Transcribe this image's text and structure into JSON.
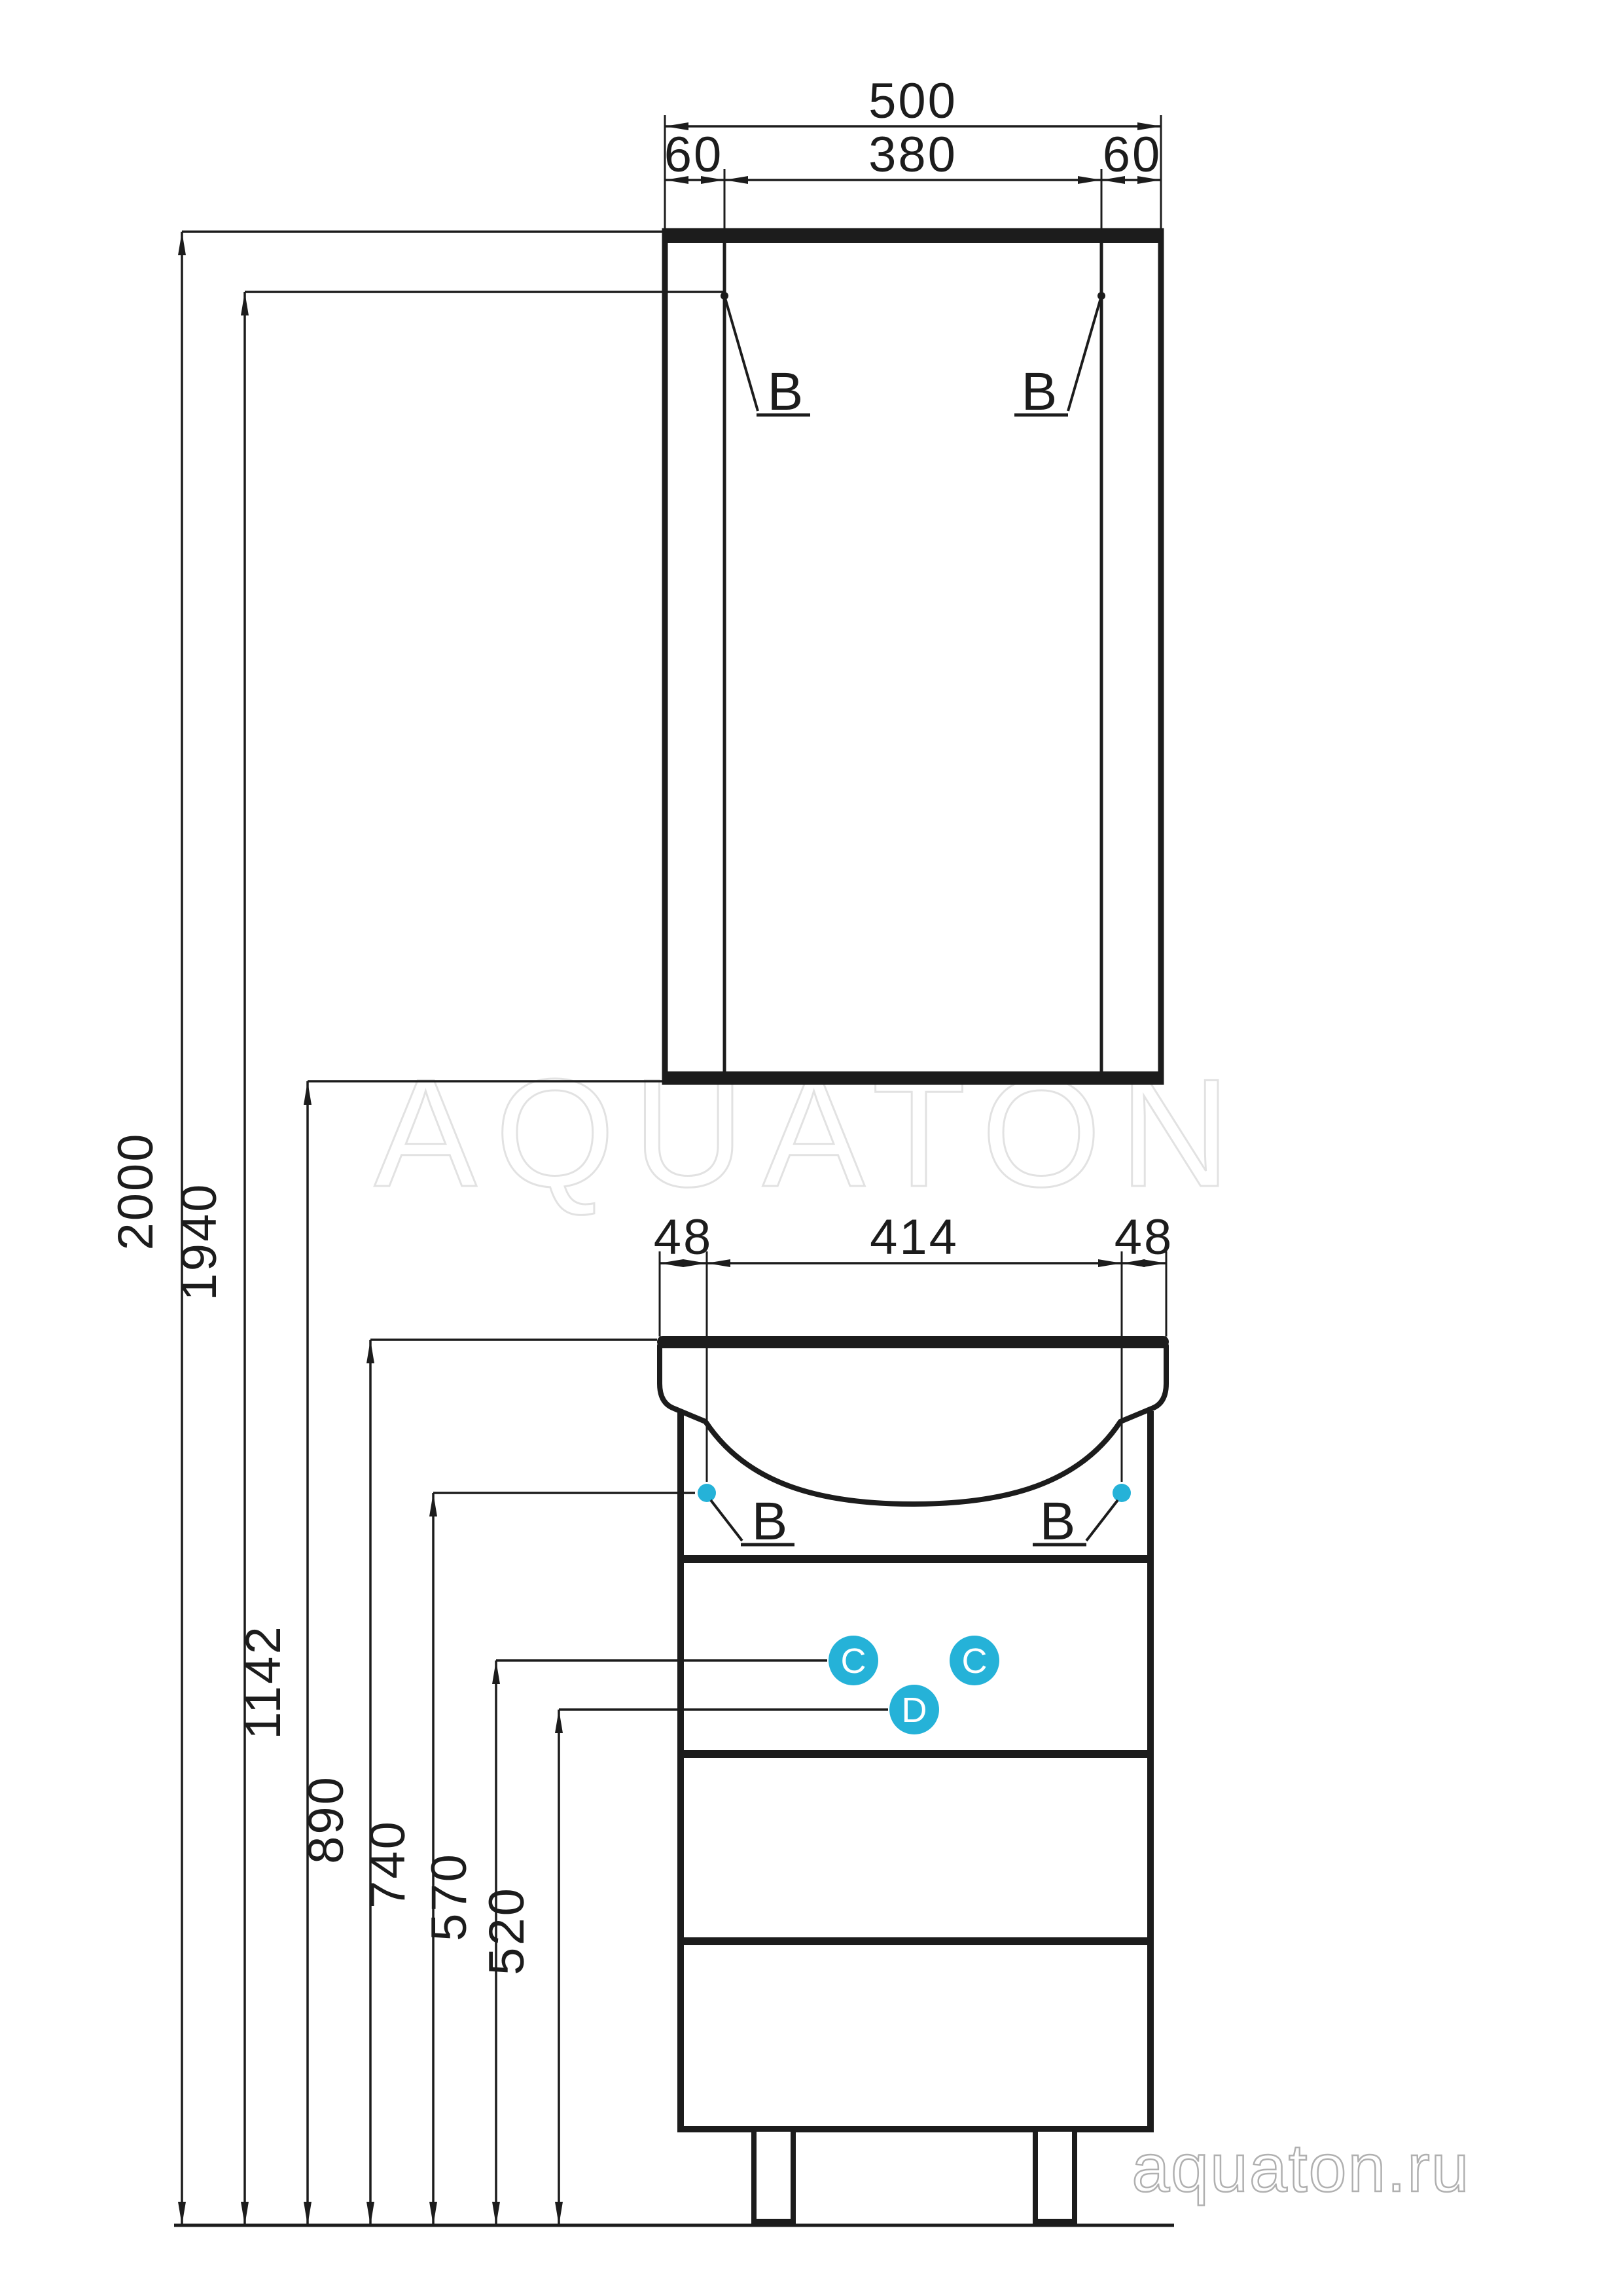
{
  "watermark": {
    "brand": "AQUATON",
    "site": "aquaton.ru"
  },
  "colors": {
    "ink": "#1c1c1c",
    "accent": "#25b2d8",
    "watermark_brand": "#e2e2e2",
    "watermark_site": "#b0b0b0"
  },
  "mirror_cabinet": {
    "width_total": "500",
    "width_left_panel": "60",
    "width_door": "380",
    "width_right_panel": "60",
    "hinge_callout_left": "B",
    "hinge_callout_right": "B"
  },
  "washbasin": {
    "offset_left": "48",
    "width_center": "414",
    "offset_right": "48",
    "mount_callout_left": "B",
    "mount_callout_right": "B"
  },
  "vanity": {
    "handle_callout_left": "C",
    "handle_callout_right": "C",
    "handle_callout_center": "D"
  },
  "heights": [
    {
      "value": "2000"
    },
    {
      "value": "1940"
    },
    {
      "value": "1142"
    },
    {
      "value": "890"
    },
    {
      "value": "740"
    },
    {
      "value": "570"
    },
    {
      "value": "520"
    }
  ]
}
